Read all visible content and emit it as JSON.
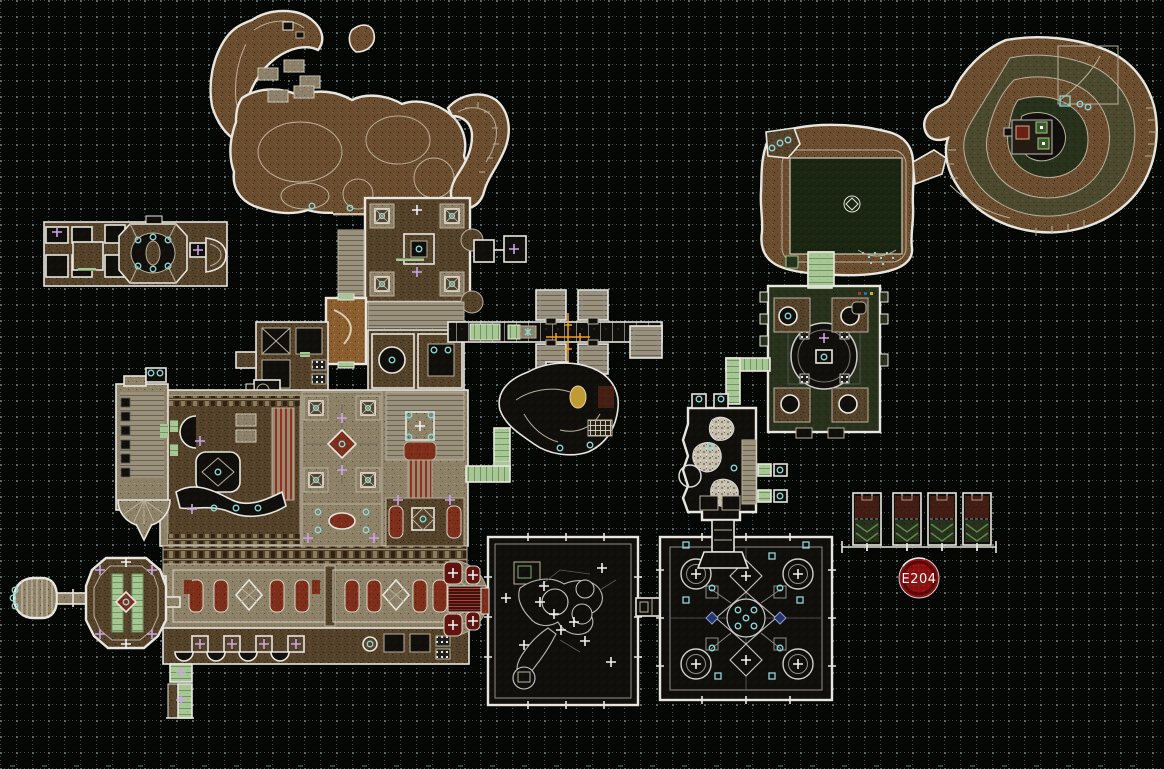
{
  "view": {
    "type": "map-editor-canvas",
    "description": "Top-down textured level map on a dotted grid"
  },
  "annotation": {
    "label": "E204"
  },
  "crosshair": {
    "x": 568,
    "y": 337
  },
  "grid": {
    "spacing_px": 16
  },
  "palette": {
    "background": "#050705",
    "grid_dot": "#3e4e4c",
    "line_white": "#e8e6df",
    "line_tan": "#b9b09c",
    "cyan": "#8fd8d8",
    "violet": "#cba6e6",
    "orange_crosshair": "#efa227",
    "annotation_red": "#8e1111",
    "annotation_text": "#ffffff",
    "brown_castle": "#55422b",
    "brown_cave": "#6b4e2f",
    "tan_floor": "#8d8168",
    "dark_interior": "#100f0c",
    "green_dark": "#27311b",
    "green_pond": "#1b2612",
    "green_path": "#a7c795",
    "red_masonry": "#7d2f1c"
  },
  "structures": [
    "nw-temple",
    "north-caves",
    "central-castle",
    "west-wing",
    "west-key-halls",
    "east-corridor-rooms",
    "map-origin-crosshair",
    "center-cave",
    "southwest-arena",
    "southeast-arena",
    "east-cells",
    "annotation-e204",
    "east-keep",
    "rock-house",
    "northeast-courtyard",
    "northeast-mountain"
  ]
}
